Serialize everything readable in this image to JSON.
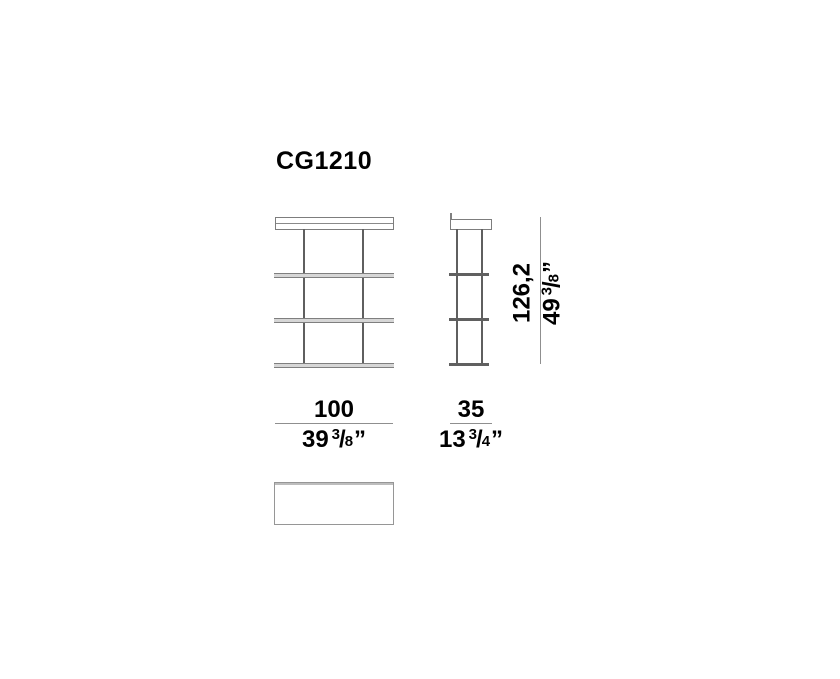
{
  "title": "CG1210",
  "colors": {
    "background": "#ffffff",
    "outline_gray": "#7d7d7d",
    "post_gray": "#5f5f5f",
    "dimension_line_gray": "#8f8f8f",
    "text": "#000000"
  },
  "views": {
    "front_shelf_count": 3,
    "side_shelf_count": 3
  },
  "dimensions": {
    "width": {
      "metric": "100",
      "imperial": {
        "whole": "39",
        "numerator": "3",
        "slash": "/",
        "denominator": "8",
        "unit": "”"
      }
    },
    "depth": {
      "metric": "35",
      "imperial": {
        "whole": "13",
        "numerator": "3",
        "slash": "/",
        "denominator": "4",
        "unit": "”"
      }
    },
    "height": {
      "metric": "126,2",
      "imperial": {
        "whole": "49",
        "numerator": "3",
        "slash": "/",
        "denominator": "8",
        "unit": "”"
      }
    }
  }
}
